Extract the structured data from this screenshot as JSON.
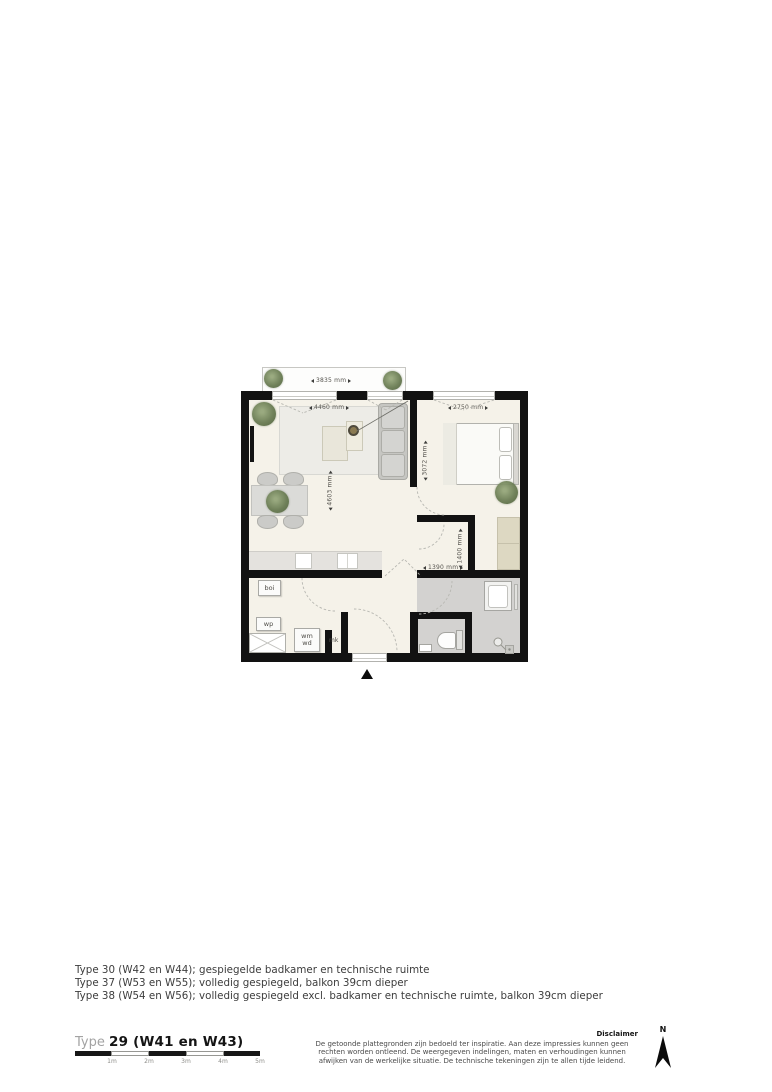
{
  "plan": {
    "dimensions": {
      "balcony_width": "3835 mm",
      "living_width": "4460 mm",
      "living_depth": "4603 mm",
      "bedroom_width": "2750 mm",
      "bedroom_depth": "3072 mm",
      "hall_width": "1390 mm",
      "hall_depth": "1400 mm"
    },
    "room_labels": {
      "boiler": "boi",
      "heat_pump": "wp",
      "washer": "wm",
      "dryer": "wd",
      "meter_cupboard": "mk"
    }
  },
  "notes": {
    "lines": [
      "Type 30 (W42 en W44); gespiegelde badkamer en technische ruimte",
      "Type 37 (W53 en W55); volledig gespiegeld, balkon 39cm dieper",
      "Type 38 (W54 en W56); volledig gespiegeld excl. badkamer en technische ruimte, balkon 39cm dieper"
    ]
  },
  "footer": {
    "type_prefix": "Type",
    "type_value": "29 (W41 en W43)",
    "scale_labels": [
      "1m",
      "2m",
      "3m",
      "4m",
      "5m"
    ],
    "disclaimer_title": "Disclaimer",
    "disclaimer_body": "De getoonde plattegronden zijn bedoeld ter inspiratie. Aan deze impressies kunnen geen rechten worden ontleend. De weergegeven indelingen, maten en verhoudingen kunnen afwijken van de werkelijke situatie. De technische tekeningen zijn te allen tijde leidend.",
    "north_label": "N"
  },
  "colors": {
    "wall": "#121212",
    "floor": "#f5f2e9",
    "bathroom_floor": "#d3d2d0",
    "wardrobe_beige": "#ddd8c2",
    "plant_green": "#62744d"
  }
}
